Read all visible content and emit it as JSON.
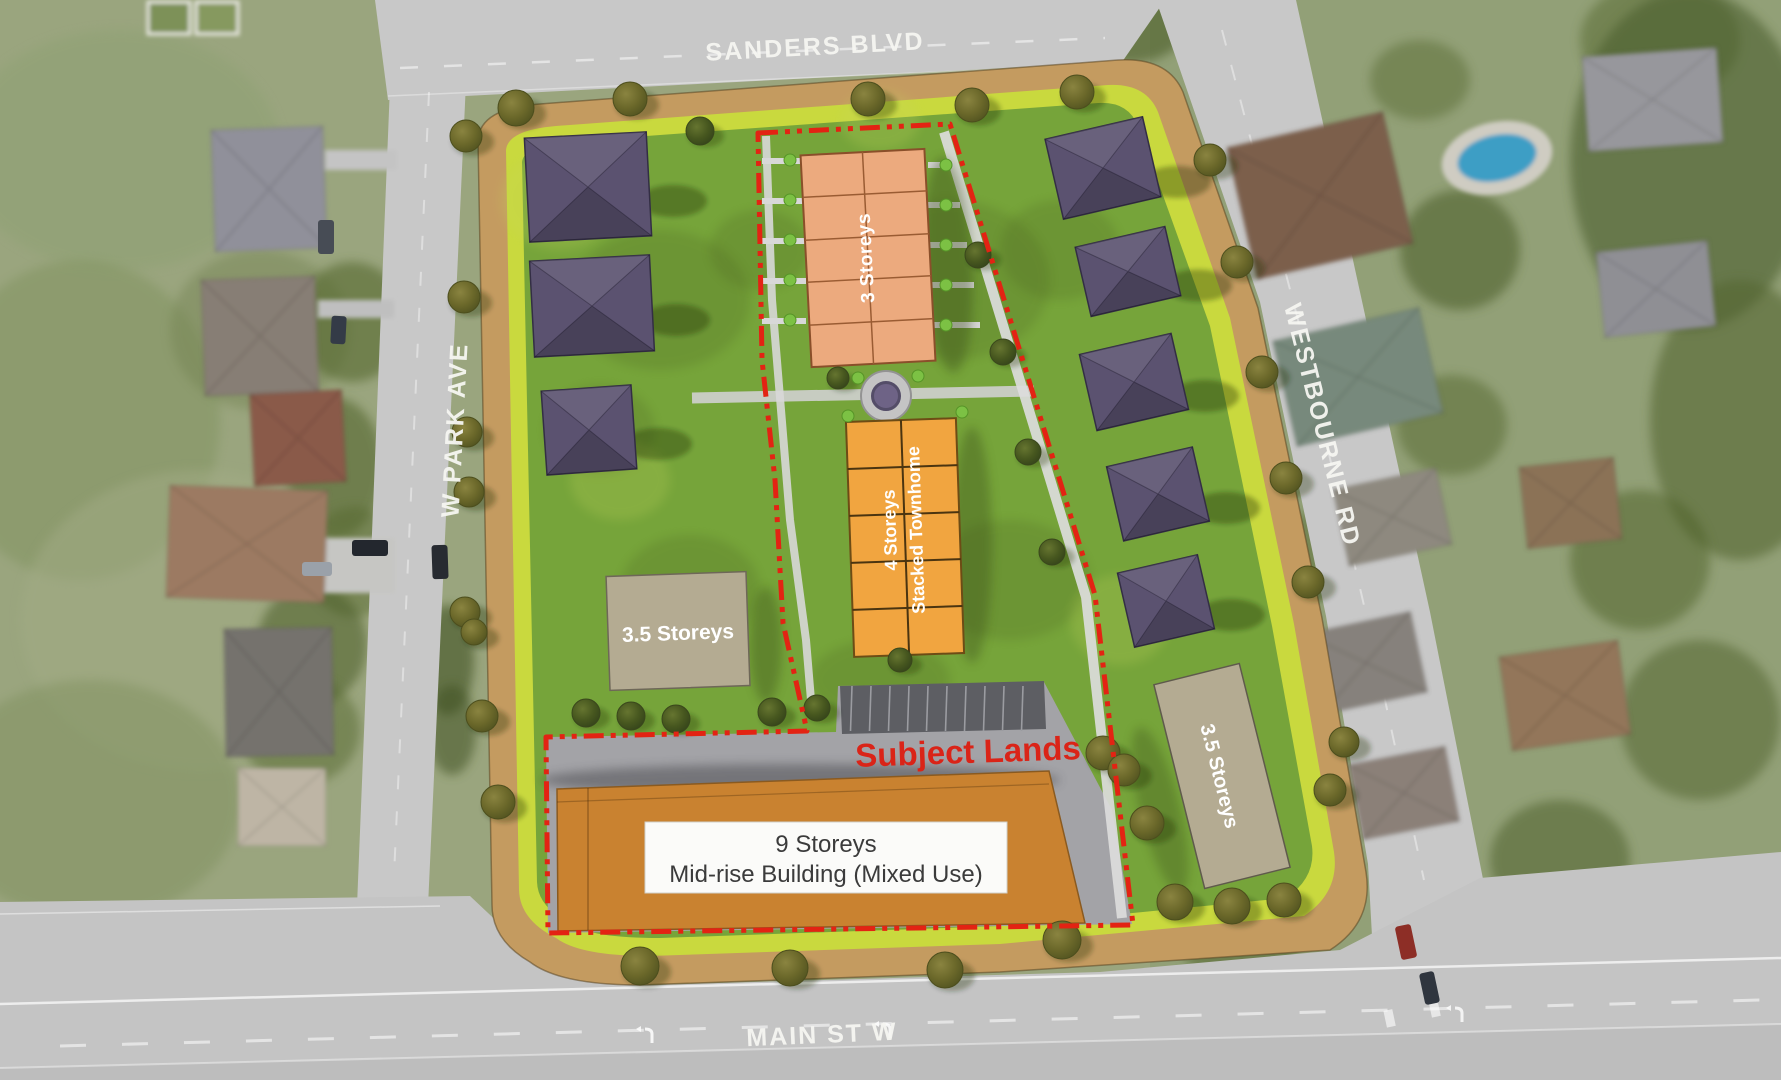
{
  "streets": {
    "sanders": "SANDERS BLVD",
    "w_park": "W PARK AVE",
    "westbourne": "WESTBOURNE RD",
    "main": "MAIN ST W"
  },
  "plan": {
    "subject_lands": "Subject Lands",
    "townhouse": "3 Storeys",
    "stacked_line1": "4 Storeys",
    "stacked_line2": "Stacked Townhome",
    "storeys35": "3.5 Storeys",
    "midrise_line1": "9 Storeys",
    "midrise_line2": "Mid-rise Building (Mixed Use)"
  },
  "colors": {
    "boundary_red": "#e32313",
    "subject_text_red": "#da2418",
    "site_border_tan": "#c49b60",
    "lime_strip": "#c9d93e",
    "lawn_green": "#76a43a",
    "townhouse_salmon": "#ecaa7e",
    "stacked_orange": "#f1a540",
    "midrise_orange": "#c98230",
    "storeys_tan": "#b4ab92",
    "house_roof_purple": "#5b5270",
    "pavement_gray": "#a3a3a7",
    "parking_gray": "#5d5e63",
    "road_gray": "#c8c8c8",
    "street_text": "#f6f6f2"
  },
  "geometry": {
    "trees_border": [
      [
        516,
        108,
        18
      ],
      [
        630,
        99,
        17
      ],
      [
        868,
        99,
        17
      ],
      [
        972,
        105,
        17
      ],
      [
        1077,
        92,
        17
      ],
      [
        466,
        136,
        16
      ],
      [
        464,
        297,
        16
      ],
      [
        467,
        432,
        15
      ],
      [
        469,
        492,
        15
      ],
      [
        465,
        612,
        15
      ],
      [
        474,
        632,
        13
      ],
      [
        482,
        716,
        16
      ],
      [
        498,
        802,
        17
      ],
      [
        640,
        966,
        19
      ],
      [
        790,
        968,
        18
      ],
      [
        945,
        970,
        18
      ],
      [
        1062,
        940,
        19
      ],
      [
        1210,
        160,
        16
      ],
      [
        1237,
        262,
        16
      ],
      [
        1262,
        372,
        16
      ],
      [
        1286,
        478,
        16
      ],
      [
        1308,
        582,
        16
      ],
      [
        1103,
        753,
        17
      ],
      [
        1124,
        770,
        16
      ],
      [
        1147,
        823,
        17
      ],
      [
        1175,
        902,
        18
      ],
      [
        1232,
        906,
        18
      ],
      [
        1284,
        900,
        17
      ],
      [
        1330,
        790,
        16
      ],
      [
        1344,
        742,
        15
      ]
    ],
    "trees_interior": [
      [
        700,
        131,
        14
      ],
      [
        586,
        713,
        14
      ],
      [
        631,
        716,
        14
      ],
      [
        676,
        719,
        14
      ],
      [
        772,
        712,
        14
      ],
      [
        817,
        708,
        13
      ],
      [
        978,
        255,
        13
      ],
      [
        1003,
        352,
        13
      ],
      [
        1028,
        452,
        13
      ],
      [
        1052,
        552,
        13
      ],
      [
        900,
        660,
        12
      ],
      [
        838,
        378,
        11
      ]
    ],
    "bushes": [
      [
        790,
        160
      ],
      [
        790,
        200
      ],
      [
        790,
        240
      ],
      [
        790,
        280
      ],
      [
        790,
        320
      ],
      [
        946,
        165
      ],
      [
        946,
        205
      ],
      [
        946,
        245
      ],
      [
        946,
        285
      ],
      [
        946,
        325
      ],
      [
        848,
        416
      ],
      [
        962,
        412
      ],
      [
        858,
        378
      ],
      [
        918,
        376
      ]
    ],
    "stubs_left": [
      158,
      198,
      238,
      278,
      318
    ],
    "stubs_right": [
      [
        928,
        162,
        26
      ],
      [
        928,
        202,
        32
      ],
      [
        929,
        242,
        38
      ],
      [
        930,
        282,
        44
      ],
      [
        930,
        322,
        50
      ]
    ],
    "site_houses_left": [
      [
        527,
        135,
        122,
        104,
        -3
      ],
      [
        532,
        258,
        120,
        96,
        -3
      ],
      [
        544,
        388,
        90,
        84,
        -4
      ]
    ],
    "site_houses_right": [
      [
        1053,
        127,
        100,
        82,
        -13
      ],
      [
        1082,
        236,
        92,
        71,
        -13
      ],
      [
        1087,
        343,
        94,
        78,
        -13
      ],
      [
        1114,
        456,
        88,
        76,
        -13
      ],
      [
        1125,
        563,
        82,
        76,
        -13
      ]
    ],
    "aerial_houses_west": [
      [
        213,
        128,
        112,
        122,
        -2,
        "#90909a"
      ],
      [
        203,
        278,
        114,
        116,
        -2,
        "#877e74"
      ],
      [
        252,
        392,
        92,
        92,
        -3,
        "#8a5a48"
      ],
      [
        168,
        488,
        158,
        112,
        2,
        "#9c7a62"
      ],
      [
        225,
        628,
        108,
        128,
        -1,
        "#75726d"
      ],
      [
        238,
        768,
        88,
        78,
        0,
        "#beb5a5"
      ]
    ],
    "aerial_houses_east": [
      [
        1240,
        128,
        160,
        135,
        -13,
        "#7c5e4b"
      ],
      [
        1585,
        52,
        135,
        95,
        -4,
        "#97979c"
      ],
      [
        1283,
        323,
        150,
        108,
        -13,
        "#77897b"
      ],
      [
        1340,
        478,
        105,
        78,
        -12,
        "#8e897f"
      ],
      [
        1523,
        462,
        95,
        82,
        -6,
        "#8b7257"
      ],
      [
        1312,
        622,
        108,
        82,
        -12,
        "#86817b"
      ],
      [
        1505,
        648,
        120,
        95,
        -8,
        "#93765a"
      ],
      [
        1355,
        755,
        98,
        76,
        -11,
        "#8b8078"
      ],
      [
        1600,
        246,
        112,
        86,
        -6,
        "#8f8f94"
      ]
    ],
    "cars": [
      [
        318,
        220,
        16,
        34,
        0,
        "#474c55"
      ],
      [
        331,
        316,
        15,
        28,
        3,
        "#343b47"
      ],
      [
        352,
        540,
        36,
        16,
        0,
        "#23272e"
      ],
      [
        302,
        562,
        30,
        14,
        0,
        "#9aa1a9"
      ],
      [
        432,
        545,
        16,
        34,
        -2,
        "#272b31"
      ],
      [
        1398,
        925,
        16,
        34,
        -12,
        "#8d2e26"
      ],
      [
        1422,
        972,
        15,
        32,
        -12,
        "#2f353e"
      ]
    ],
    "field_blobs": [
      [
        120,
        150,
        160,
        120,
        "#8ea073",
        0.5
      ],
      [
        80,
        420,
        140,
        160,
        "#7e915c",
        0.45
      ],
      [
        200,
        620,
        180,
        150,
        "#a2ab85",
        0.5
      ],
      [
        90,
        800,
        150,
        120,
        "#7a8c58",
        0.4
      ],
      [
        260,
        330,
        90,
        80,
        "#6f7f4e",
        0.4
      ],
      [
        352,
        322,
        55,
        60,
        "#55682f",
        0.6
      ],
      [
        335,
        468,
        48,
        70,
        "#4e6128",
        0.55
      ],
      [
        355,
        562,
        50,
        55,
        "#55682f",
        0.5
      ],
      [
        312,
        645,
        55,
        60,
        "#4a5c26",
        0.55
      ],
      [
        300,
        730,
        60,
        55,
        "#55682f",
        0.5
      ],
      [
        448,
        660,
        26,
        55,
        "#3f5122",
        0.6
      ],
      [
        452,
        730,
        24,
        45,
        "#3f5122",
        0.55
      ],
      [
        470,
        18,
        50,
        28,
        "#4a5c26",
        0.6
      ],
      [
        560,
        12,
        40,
        22,
        "#55682f",
        0.5
      ],
      [
        1130,
        28,
        55,
        35,
        "#4a5c26",
        0.6
      ],
      [
        1660,
        40,
        80,
        60,
        "#55682f",
        0.5
      ],
      [
        1690,
        160,
        120,
        170,
        "#4c5e2e",
        0.6
      ],
      [
        1740,
        420,
        90,
        140,
        "#546631",
        0.6
      ],
      [
        1460,
        250,
        60,
        60,
        "#4a5c26",
        0.55
      ],
      [
        1452,
        425,
        55,
        50,
        "#55682f",
        0.5
      ],
      [
        1640,
        560,
        70,
        70,
        "#4e6128",
        0.5
      ],
      [
        1700,
        720,
        80,
        80,
        "#546631",
        0.55
      ],
      [
        1560,
        860,
        70,
        60,
        "#4a5c26",
        0.5
      ],
      [
        1240,
        60,
        45,
        40,
        "#4a5c26",
        0.5
      ],
      [
        1330,
        550,
        45,
        45,
        "#55682f",
        0.45
      ],
      [
        1240,
        940,
        60,
        45,
        "#4e6128",
        0.5
      ],
      [
        1700,
        950,
        80,
        60,
        "#50622c",
        0.5
      ],
      [
        1420,
        80,
        50,
        40,
        "#55682f",
        0.45
      ]
    ],
    "lawn_blobs_dark": [
      [
        660,
        300,
        90,
        70
      ],
      [
        950,
        280,
        100,
        80
      ],
      [
        690,
        590,
        70,
        55
      ],
      [
        1010,
        580,
        80,
        60
      ],
      [
        880,
        680,
        70,
        40
      ],
      [
        760,
        250,
        50,
        40
      ],
      [
        1060,
        250,
        60,
        50
      ],
      [
        600,
        430,
        55,
        45
      ]
    ],
    "lawn_blobs_light": [
      [
        560,
        200,
        60,
        50
      ],
      [
        620,
        480,
        50,
        40
      ],
      [
        1120,
        620,
        50,
        45
      ],
      [
        880,
        120,
        40,
        30
      ]
    ]
  }
}
